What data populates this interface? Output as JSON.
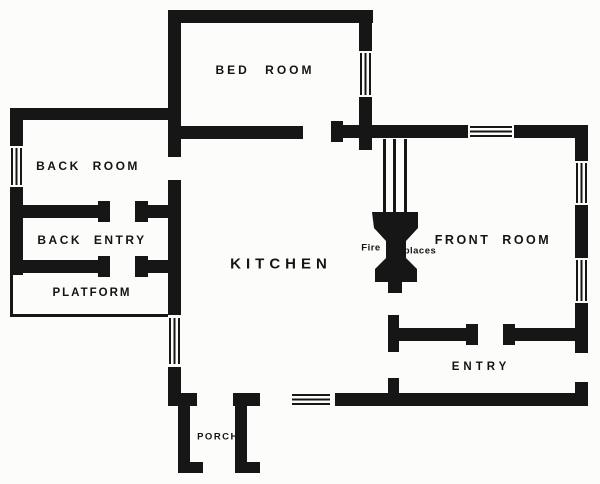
{
  "diagram": {
    "type": "house floor plan",
    "rooms": [
      {
        "id": "bed-room",
        "label": "BED ROOM"
      },
      {
        "id": "back-room",
        "label": "BACK ROOM"
      },
      {
        "id": "back-entry",
        "label": "BACK ENTRY"
      },
      {
        "id": "platform",
        "label": "PLATFORM"
      },
      {
        "id": "kitchen",
        "label": "KITCHEN"
      },
      {
        "id": "front-room",
        "label": "FRONT ROOM"
      },
      {
        "id": "entry",
        "label": "ENTRY"
      },
      {
        "id": "porch",
        "label": "PORCH"
      }
    ],
    "annotations": {
      "fireplace_word_left": "Fire",
      "fireplace_word_right": "places"
    },
    "features": {
      "fireplace": "back-to-back fireplaces between kitchen and front room",
      "windows": 7,
      "doors": 9
    },
    "colors": {
      "wall": "#161616",
      "background": "#fcfcfb"
    }
  }
}
